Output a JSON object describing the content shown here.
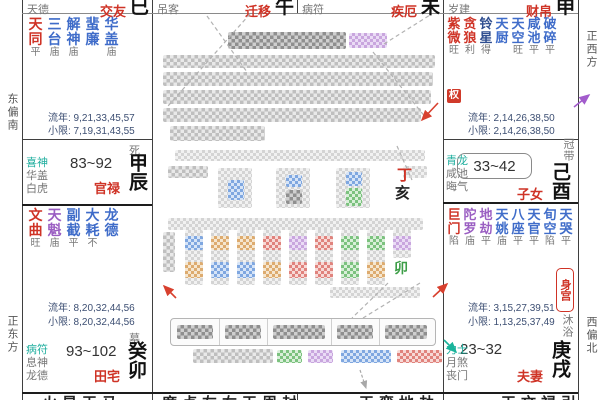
{
  "chart": {
    "title_note": "zi-wei-dou-shu natal chart, personal info redacted by mosaic",
    "directions": {
      "top_left": "东偏南",
      "bottom_left": "正东方",
      "top_right": "正西方",
      "bottom_right": "西偏北"
    },
    "palaces": {
      "si": {
        "god_label": "天德",
        "name": "交友",
        "branch": "巳",
        "stars": [
          {
            "name": "天同",
            "color": "red",
            "bright": "平"
          },
          {
            "name": "三台",
            "color": "blue",
            "bright": "庙"
          },
          {
            "name": "解神",
            "color": "blue",
            "bright": "庙"
          },
          {
            "name": "蜚廉",
            "color": "blue",
            "bright": ""
          },
          {
            "name": "华盖",
            "color": "blue",
            "bright": "庙"
          }
        ],
        "liunian": "流年: 9,21,33,45,57",
        "xiaoxian": "小限: 7,19,31,43,55"
      },
      "wu": {
        "god_label": "吊客",
        "name": "迁移",
        "branch": "午"
      },
      "wei": {
        "god_label": "病符",
        "name": "疾厄",
        "branch": "未"
      },
      "shen": {
        "god_label": "岁建",
        "name": "财帛",
        "branch": "申",
        "hua": "权",
        "stars": [
          {
            "name": "紫微",
            "color": "red",
            "bright": "旺"
          },
          {
            "name": "贪狼",
            "color": "red",
            "bright": "利"
          },
          {
            "name": "铃星",
            "color": "navy",
            "bright": "得"
          },
          {
            "name": "天厨",
            "color": "blue",
            "bright": ""
          },
          {
            "name": "天空",
            "color": "blue",
            "bright": "旺"
          },
          {
            "name": "咸池",
            "color": "blue",
            "bright": "平"
          },
          {
            "name": "破碎",
            "color": "blue",
            "bright": "平"
          }
        ],
        "liunian": "流年: 2,14,26,38,50",
        "xiaoxian": "小限: 2,14,26,38,50"
      },
      "chen": {
        "stage": "死",
        "gods": [
          "喜神",
          "华盖",
          "白虎"
        ],
        "age_range": "83~92",
        "name": "官禄",
        "ganzhi": "甲辰"
      },
      "you": {
        "stage": "冠带",
        "gods": [
          "青龙",
          "咸池",
          "晦气"
        ],
        "age_range": "33~42",
        "name": "子女",
        "ganzhi": "己酉"
      },
      "mao": {
        "stars": [
          {
            "name": "文曲",
            "color": "red",
            "bright": "旺"
          },
          {
            "name": "天魁",
            "color": "purple",
            "bright": "庙"
          },
          {
            "name": "副截",
            "color": "blue",
            "bright": "平"
          },
          {
            "name": "大耗",
            "color": "blue",
            "bright": "不"
          },
          {
            "name": "龙德",
            "color": "blue",
            "bright": ""
          }
        ],
        "liunian": "流年: 8,20,32,44,56",
        "xiaoxian": "小限: 8,20,32,44,56",
        "stage": "墓",
        "gods": [
          "病符",
          "息神",
          "龙德"
        ],
        "age_range": "93~102",
        "name": "田宅",
        "ganzhi": "癸卯"
      },
      "xu": {
        "stars": [
          {
            "name": "巨门",
            "color": "red",
            "bright": "陷"
          },
          {
            "name": "陀罗",
            "color": "purple",
            "bright": "庙"
          },
          {
            "name": "地劫",
            "color": "purple",
            "bright": "平"
          },
          {
            "name": "天姚",
            "color": "blue",
            "bright": "庙"
          },
          {
            "name": "八座",
            "color": "blue",
            "bright": "平"
          },
          {
            "name": "天官",
            "color": "blue",
            "bright": "平"
          },
          {
            "name": "旬空",
            "color": "blue",
            "bright": "陷"
          },
          {
            "name": "天哭",
            "color": "blue",
            "bright": "平"
          }
        ],
        "body_badge": "身宫",
        "liunian": "流年: 3,15,27,39,51",
        "xiaoxian": "小限: 1,13,25,37,49",
        "stage": "沐浴",
        "gods": [
          "力士",
          "月煞",
          "丧门"
        ],
        "age_range": "23~32",
        "name": "夫妻",
        "ganzhi": "庚戌"
      }
    },
    "center": {
      "redacted": true,
      "visible_chars": {
        "hour_stem": "丁",
        "hour_branch": "亥",
        "day_branch_tag": "卯"
      }
    },
    "bottom_partial": {
      "cells": [
        "火星天马",
        "廉贞左右天周封月",
        "天鸾地劫",
        "天文禄引"
      ]
    },
    "colors": {
      "main_star_red": "#cf3326",
      "minor_star_blue": "#3f6cc9",
      "star_purple": "#9a5ec2",
      "god_teal": "#1fae9e",
      "hua_badge_bg": "#d03a2a",
      "grid": "#3f3f3f"
    }
  }
}
